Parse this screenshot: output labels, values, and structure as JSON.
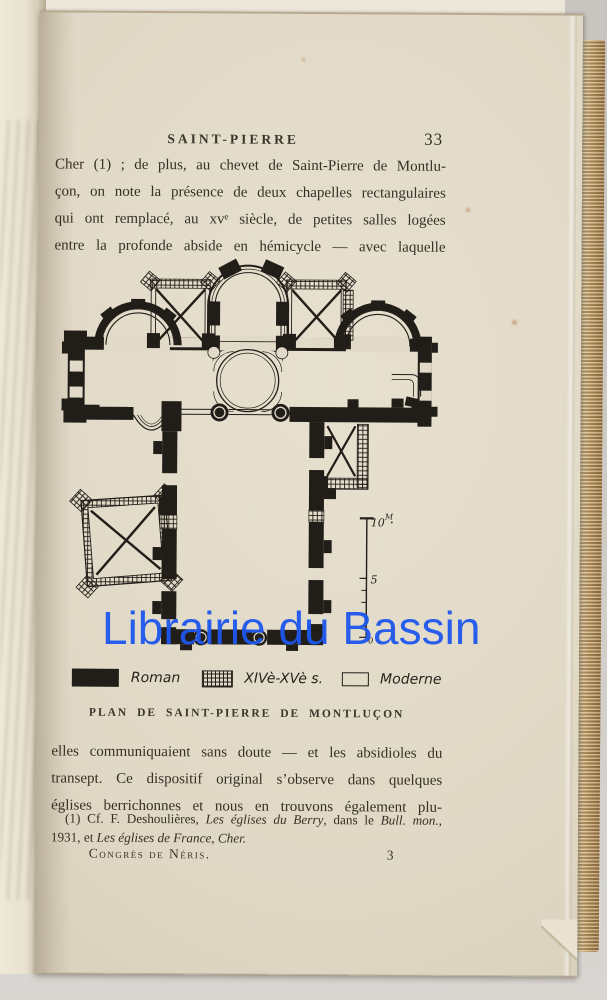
{
  "photo": {
    "background_color": "#cfccc8",
    "page_color": "#e2dac8",
    "ink_color": "#211d18"
  },
  "watermark": {
    "text": "Librairie du Bassin",
    "color": "#1e57ee"
  },
  "page": {
    "header": {
      "running_title": "SAINT-PIERRE",
      "page_number": "33"
    },
    "paragraph1": {
      "lines": [
        "Cher (1) ; de plus, au chevet de Saint-Pierre de Montlu-",
        "çon, on note la présence de deux chapelles rectangulaires",
        "qui ont remplacé, au xvᵉ siècle, de petites salles logées",
        "entre la profonde abside en hémicycle — avec laquelle"
      ]
    },
    "plan": {
      "scale": {
        "ten": "10",
        "unit": "M",
        "five": "5",
        "zero": "0"
      },
      "legend": [
        {
          "swatch": "solid-black",
          "label": "Roman"
        },
        {
          "swatch": "crosshatch",
          "label": "XIVè-XVè s."
        },
        {
          "swatch": "outline",
          "label": "Moderne"
        }
      ],
      "caption": "PLAN DE SAINT-PIERRE DE MONTLUÇON"
    },
    "paragraph2": {
      "lines": [
        "elles communiquaient sans doute — et les absidioles du",
        "transept. Ce dispositif original s’observe dans quelques",
        "églises berrichonnes et nous en trouvons également plu-"
      ]
    },
    "footnote": {
      "line1_segments": [
        {
          "text": "(1) Cf. F. Deshoulières, "
        },
        {
          "text": "Les églises du Berry"
        },
        {
          "text": ", dans le "
        },
        {
          "text": "Bull. mon."
        },
        {
          "text": ","
        }
      ],
      "line2_segments": [
        {
          "text": "1931, et "
        },
        {
          "text": "Les églises de France, Cher."
        }
      ]
    },
    "footer": {
      "left": "Congrès de Néris.",
      "signature": "3"
    }
  }
}
